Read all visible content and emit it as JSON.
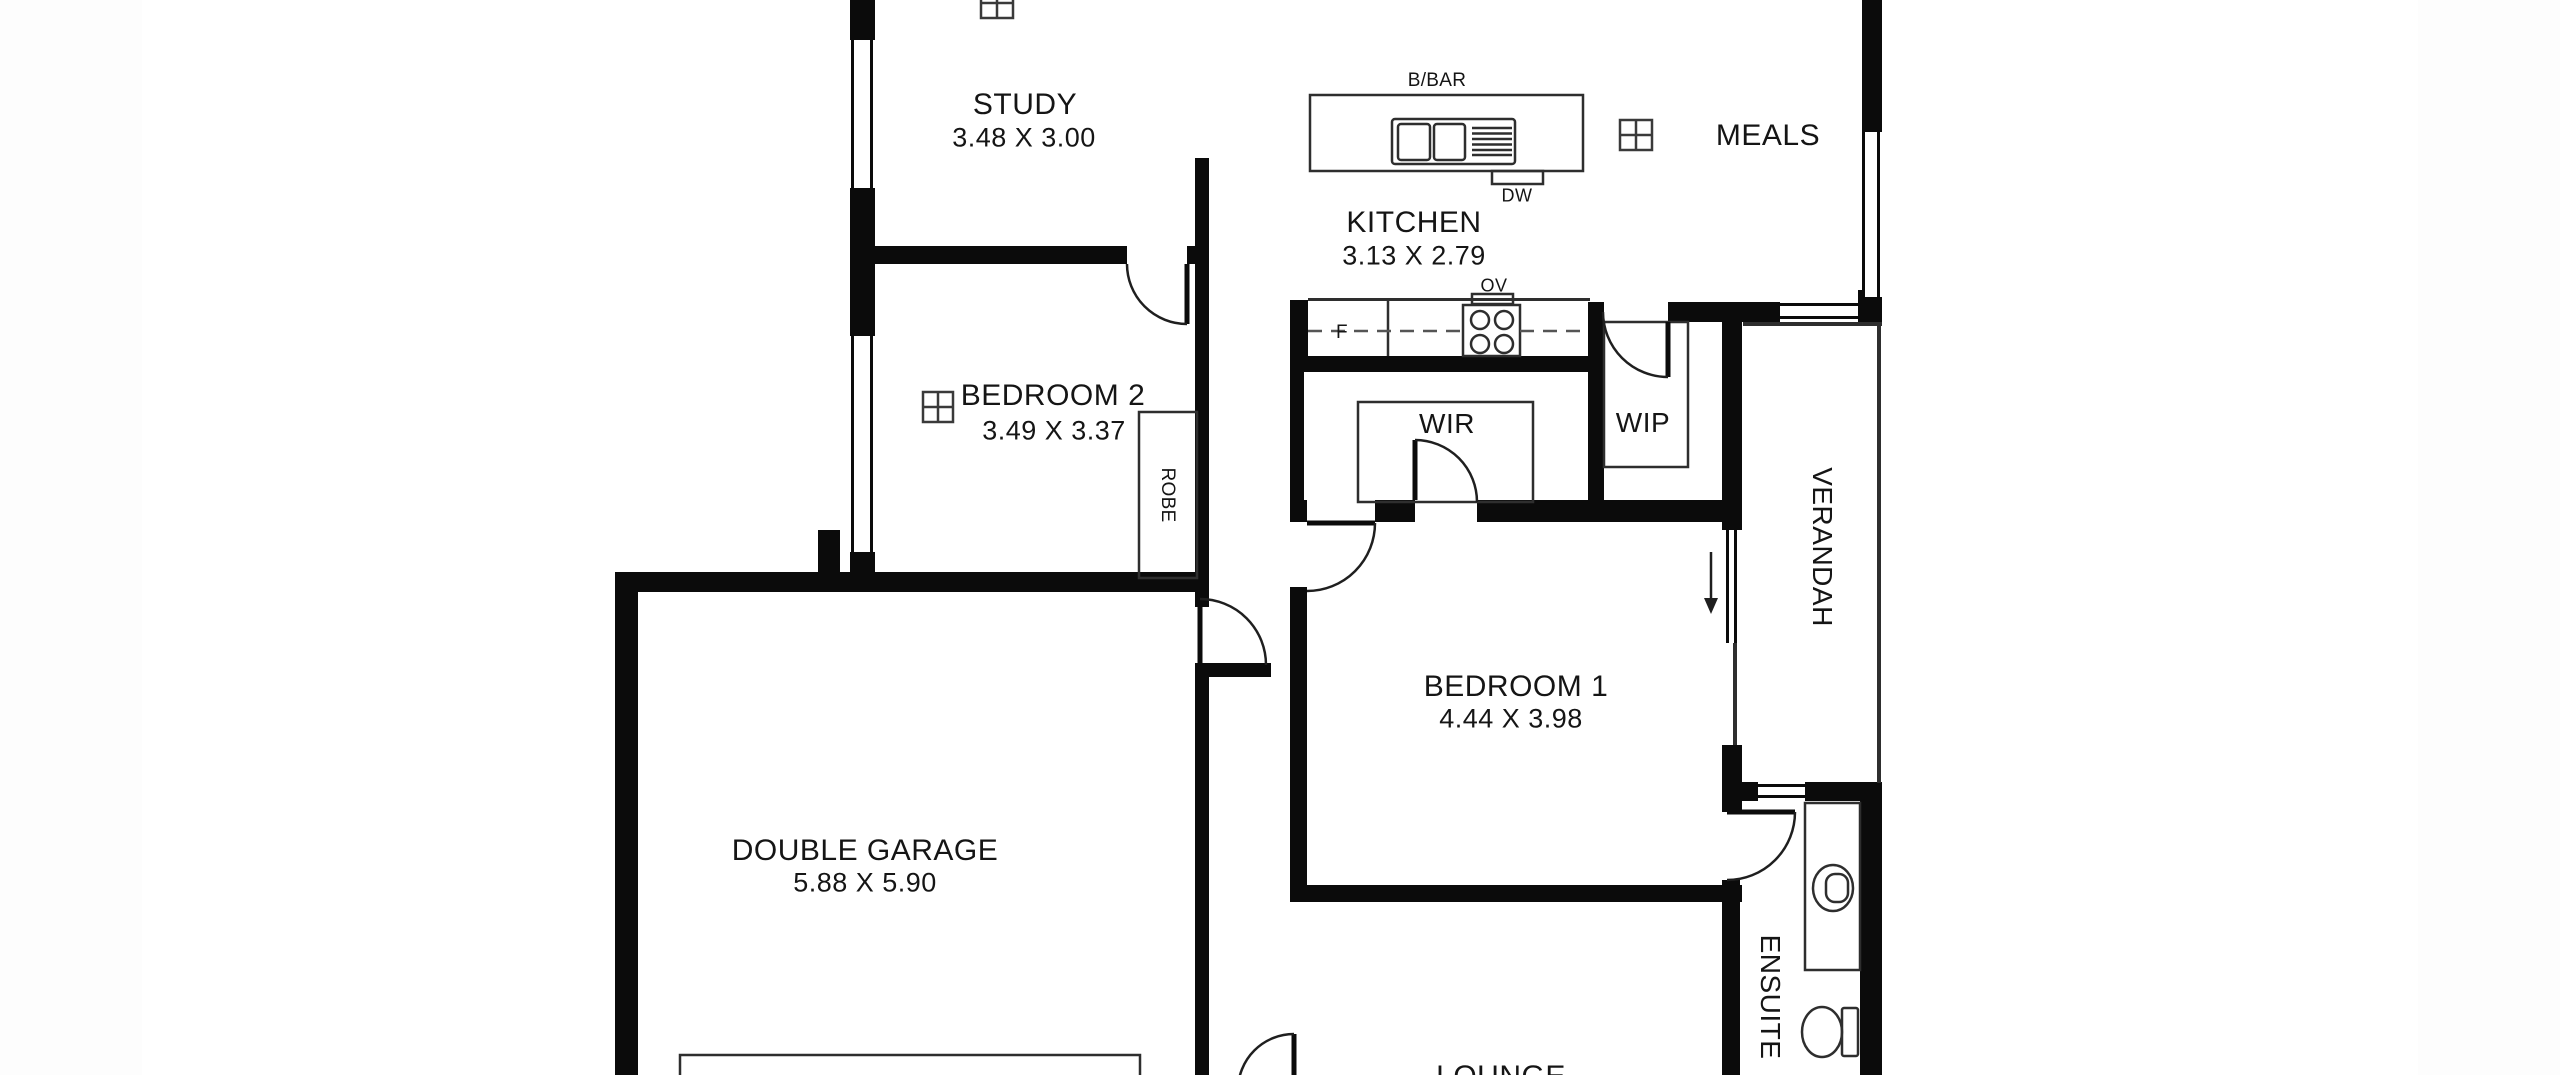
{
  "canvas": {
    "background": "#ffffff",
    "wall_color": "#0b0b0b",
    "line_color": "#2e2e2e",
    "text_color": "#151515"
  },
  "rooms": {
    "study": {
      "label": "STUDY",
      "dims": "3.48 X 3.00"
    },
    "meals": {
      "label": "MEALS"
    },
    "kitchen": {
      "label": "KITCHEN",
      "dims": "3.13 X 2.79"
    },
    "bedroom2": {
      "label": "BEDROOM 2",
      "dims": "3.49 X 3.37"
    },
    "wir": {
      "label": "WIR"
    },
    "wip": {
      "label": "WIP"
    },
    "robe": {
      "label": "ROBE"
    },
    "verandah": {
      "label": "VERANDAH"
    },
    "bedroom1": {
      "label": "BEDROOM 1",
      "dims": "4.44 X 3.98"
    },
    "garage": {
      "label": "DOUBLE GARAGE",
      "dims": "5.88 X 5.90"
    },
    "ensuite": {
      "label": "ENSUITE"
    },
    "lounge": {
      "label": "LOUNGE"
    }
  },
  "fixtures": {
    "breakfast_bar": "B/BAR",
    "dishwasher": "DW",
    "oven": "OV",
    "fridge": "F"
  }
}
